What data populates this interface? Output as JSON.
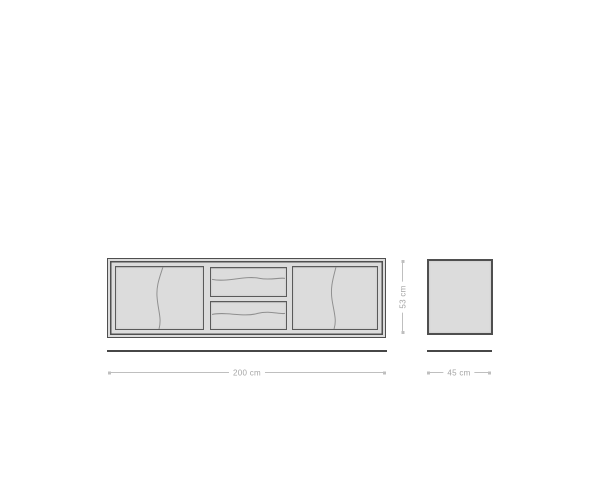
{
  "dimensions": {
    "width_label": "200 cm",
    "height_label": "53 cm",
    "depth_label": "45 cm"
  },
  "colors": {
    "background": "#ffffff",
    "fill": "#dcdcdc",
    "outline": "#4f4f4f",
    "panel_outline": "#5a5a5a",
    "grain_line": "#8f8f8f",
    "baseline": "#474747",
    "dim_line": "#bfbfbf",
    "dim_text": "#a5a5a5"
  }
}
